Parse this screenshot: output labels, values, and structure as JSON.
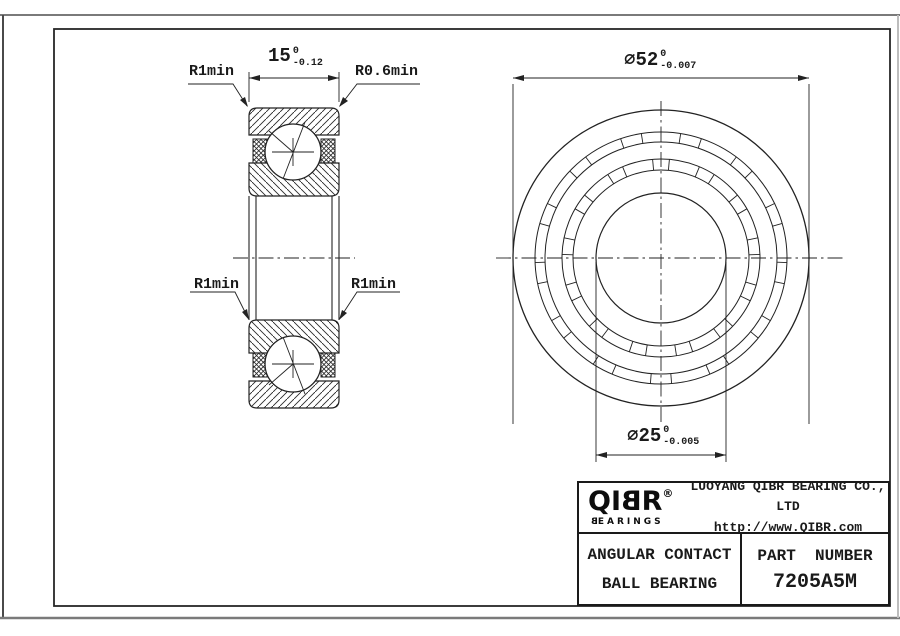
{
  "drawing": {
    "section_labels": {
      "top_left_radius": "R1min",
      "top_right_radius": "R0.6min",
      "mid_left_radius": "R1min",
      "mid_right_radius": "R1min",
      "width": {
        "value": "15",
        "tol_upper": "0",
        "tol_lower": "-0.12"
      }
    },
    "front_labels": {
      "outer_diameter": {
        "value": "⌀52",
        "tol_upper": "0",
        "tol_lower": "-0.007"
      },
      "bore_diameter": {
        "value": "⌀25",
        "tol_upper": "0",
        "tol_lower": "-0.005"
      }
    }
  },
  "title_block": {
    "logo": {
      "q_i": "QI",
      "b": "B",
      "r": "R",
      "registered": "®",
      "sub_first": "B",
      "sub_rest": "EARINGS"
    },
    "company_name": "LUOYANG QIBR BEARING CO., LTD",
    "website": "http://www.QIBR.com",
    "product_type_line1": "ANGULAR CONTACT",
    "product_type_line2": "BALL BEARING",
    "part_number_label": "PART  NUMBER",
    "part_number": "7205A5M"
  },
  "colors": {
    "line": "#1f1f1f",
    "background": "#ffffff"
  }
}
